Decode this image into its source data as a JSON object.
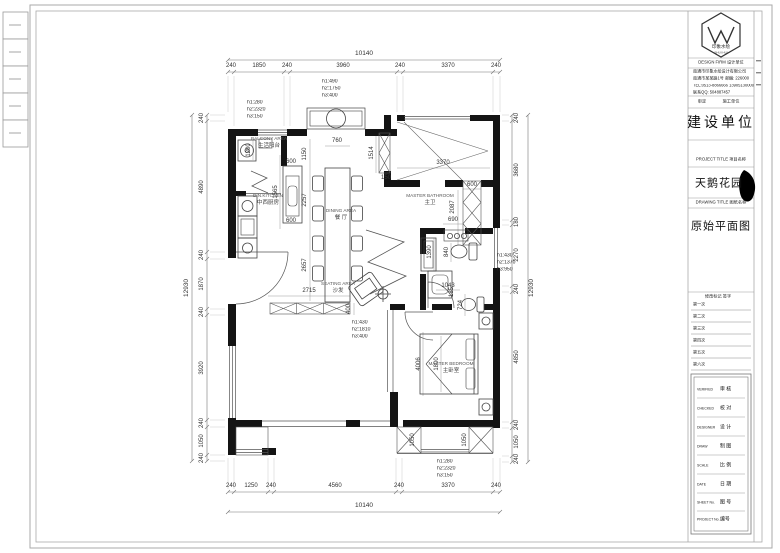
{
  "plan": {
    "totals": {
      "top": "10140",
      "bottom": "10140",
      "left": "12930",
      "right": "12930"
    },
    "top_chain": [
      "240",
      "1850",
      "240",
      "3960",
      "240",
      "3370",
      "240"
    ],
    "bottom_chain": [
      "240",
      "1250",
      "240",
      "4560",
      "240",
      "3370",
      "240"
    ],
    "left_chain": [
      "240",
      "4890",
      "240",
      "1870",
      "240",
      "3920",
      "240",
      "1050",
      "240"
    ],
    "right_chain": [
      "240",
      "3680",
      "180",
      "2270",
      "240",
      "4850",
      "240",
      "1050",
      "240"
    ],
    "inner": [
      "760",
      "1150",
      "2257",
      "2657",
      "2715",
      "400",
      "600",
      "1565",
      "600",
      "1200",
      "3370",
      "1514",
      "150",
      "600",
      "2087",
      "690",
      "1390",
      "840",
      "1043",
      "724",
      "185",
      "4006",
      "1800",
      "1050",
      "1050"
    ],
    "notes": {
      "top": [
        "h1:490",
        "h2:1750",
        "h3:400"
      ],
      "top_left": [
        "h1:280",
        "h2:2320",
        "h3:150"
      ],
      "right": [
        "h1:430",
        "h2:1370",
        "h3:950"
      ],
      "living": [
        "h1:430",
        "h2:1810",
        "h3:400"
      ],
      "bottom": [
        "h1:280",
        "h2:2320",
        "h3:150"
      ]
    },
    "rooms": {
      "balcony": {
        "en": "BALCONY AREA",
        "cn": "生活阳台"
      },
      "kitchen": {
        "en": "DIN.KITCHEN",
        "cn": "中西厨房"
      },
      "dining": {
        "en": "DINING AREA",
        "cn": "餐 厅"
      },
      "seating": {
        "en": "SEATING AREA",
        "cn": "沙发"
      },
      "bath": {
        "en": "MASTER BATHROOM",
        "cn": "主卫"
      },
      "master": {
        "en": "MASTER BEDROOM",
        "cn": "主卧室"
      }
    }
  },
  "title_block": {
    "logo_cn": "印象水绘",
    "logo_en": "SHUI HUI",
    "design_firm_row": "DESIGN FIRM   设计单位",
    "company_lines": [
      "南通市印象水绘设计有限公司",
      "南通市某某路1号  邮编: 226000",
      "TEL:0513-8866666  13905130000",
      "联系QQ: 504887457"
    ],
    "pair_left": "审定",
    "pair_right": "施工单位",
    "construction_unit": "建设单位",
    "project_title_row": "PROJECT TITLE   项目名称",
    "project_name": "天鹅花园",
    "drawing_title_row": "DRAWING TITLE   图纸名称",
    "drawing_name": "原始平面图",
    "revision_header": "修改标记  签字",
    "revisions": [
      "第一次",
      "第二次",
      "第三次",
      "第四次",
      "第五次",
      "第六次"
    ],
    "sign_rows": [
      {
        "en": "VERIFIED",
        "cn": "审  核"
      },
      {
        "en": "CHECKED",
        "cn": "校  对"
      },
      {
        "en": "DESIGNER",
        "cn": "设  计"
      },
      {
        "en": "DRAW",
        "cn": "制  图"
      },
      {
        "en": "SCALE",
        "cn": "比  例"
      },
      {
        "en": "DATE",
        "cn": "日  期"
      },
      {
        "en": "SHEET No.",
        "cn": "图 号"
      },
      {
        "en": "PROJECT No.",
        "cn": "编号"
      }
    ]
  }
}
